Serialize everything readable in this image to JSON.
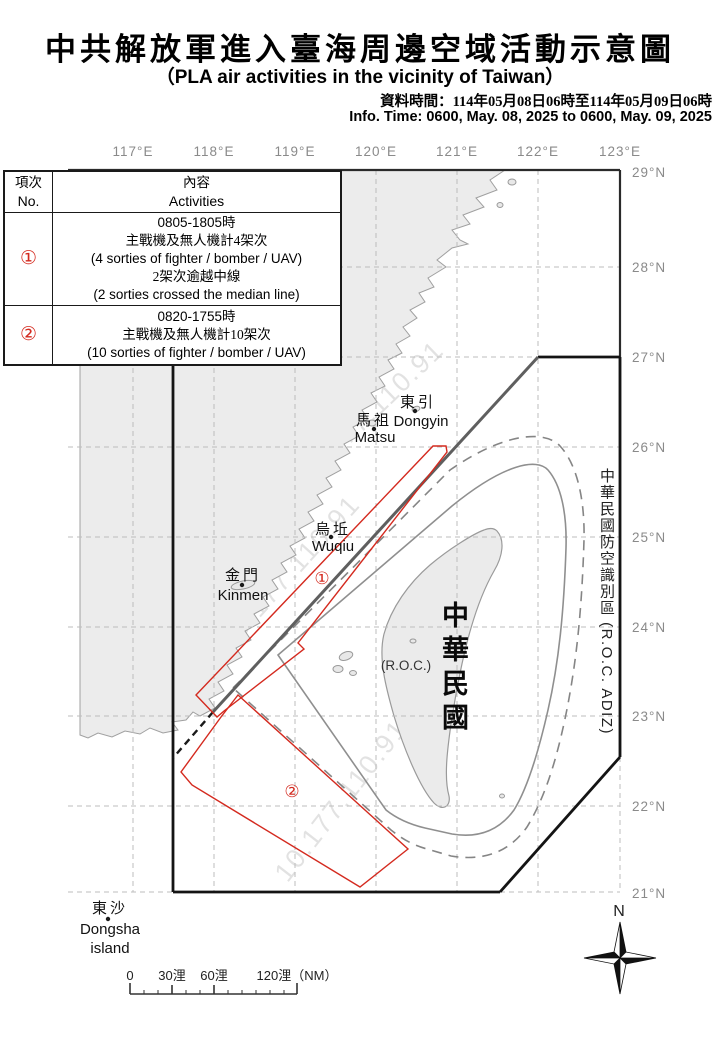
{
  "title": {
    "zh": "中共解放軍進入臺海周邊空域活動示意圖",
    "en": "（PLA air activities in the vicinity of Taiwan）",
    "info_zh": "資料時間：114年05月08日06時至114年05月09日06時",
    "info_en": "Info. Time: 0600, May. 08, 2025 to 0600, May. 09, 2025"
  },
  "table": {
    "col_no_zh": "項次",
    "col_no_en": "No.",
    "col_act_zh": "內容",
    "col_act_en": "Activities",
    "rows": [
      {
        "no": "①",
        "lines": [
          "0805-1805時",
          "主戰機及無人機計4架次",
          "(4 sorties of fighter / bomber / UAV)",
          "2架次逾越中線",
          "(2 sorties crossed the median line)"
        ]
      },
      {
        "no": "②",
        "lines": [
          "0820-1755時",
          "主戰機及無人機計10架次",
          "(10 sorties of fighter / bomber / UAV)"
        ]
      }
    ]
  },
  "axes": {
    "lon": [
      "117°E",
      "118°E",
      "119°E",
      "120°E",
      "121°E",
      "122°E",
      "123°E"
    ],
    "lat": [
      "29°N",
      "28°N",
      "27°N",
      "26°N",
      "25°N",
      "24°N",
      "23°N",
      "22°N",
      "21°N"
    ]
  },
  "map_labels": {
    "dongyin_zh": "東引",
    "dongyin_en": "Dongyin",
    "matsu_zh": "馬祖",
    "matsu_en": "Matsu",
    "wuqiu_zh": "烏坵",
    "wuqiu_en": "Wuqiu",
    "kinmen_zh": "金門",
    "kinmen_en": "Kinmen",
    "dongsha_zh": "東沙",
    "dongsha_en1": "Dongsha",
    "dongsha_en2": "island",
    "roc_paren": "(R.O.C.)",
    "roc_big": "中華民國",
    "adiz_zh": "中華民國防空識別區",
    "adiz_en": " (R.O.C. ADIZ)",
    "marker1": "①",
    "marker2": "②",
    "north": "N",
    "watermark": "10.177.110.91"
  },
  "scalebar": {
    "t0": "0",
    "t30": "30浬",
    "t60": "60浬",
    "t120": "120浬（NM）"
  },
  "colors": {
    "accent_red": "#d42a1f",
    "land_fill": "#ececec",
    "coast_line": "#a0a0a0",
    "grid_line": "#bdbdbd",
    "adiz_line": "#141414",
    "median_line": "#5f5f5f",
    "axis_label": "#8a8a8a"
  }
}
